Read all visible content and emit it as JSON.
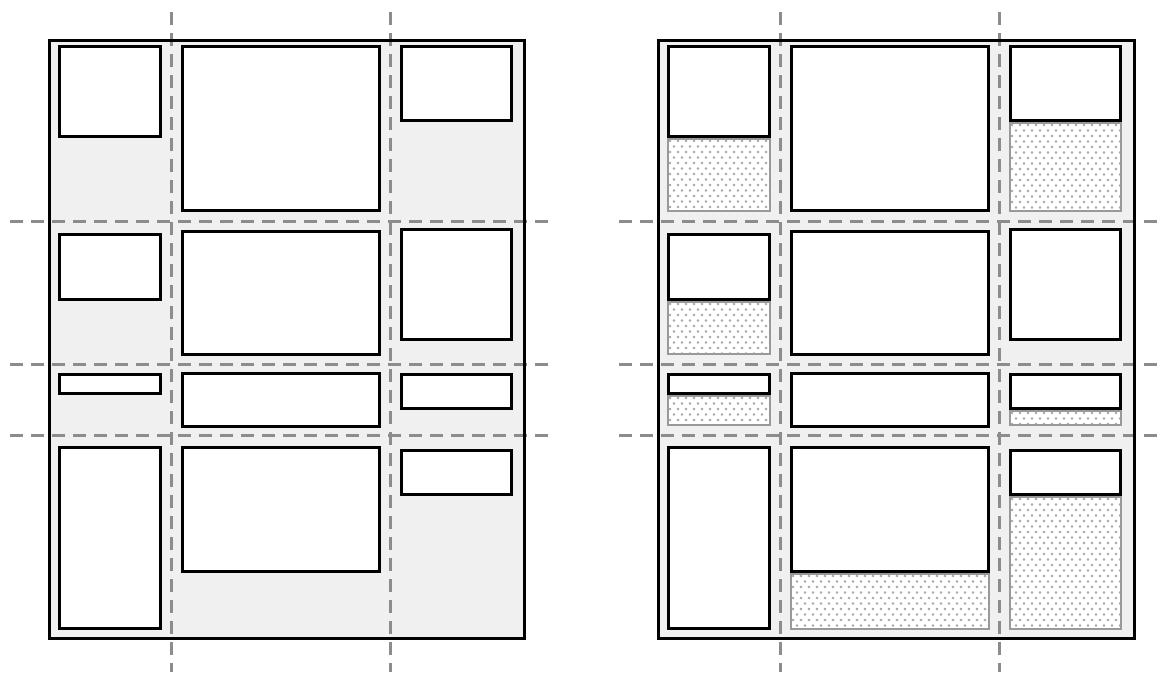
{
  "canvas": {
    "width": 1171,
    "height": 679,
    "background": "#ffffff"
  },
  "colors": {
    "container_fill": "#f0f0f0",
    "container_border": "#000000",
    "item_fill": "#ffffff",
    "item_border": "#000000",
    "grid_line": "#8c8c8c",
    "leftover_border": "#999999",
    "leftover_dots": "#a8a8a8"
  },
  "figures": [
    {
      "id": "plain-grid",
      "container": {
        "x": 48,
        "y": 39,
        "w": 478,
        "h": 601
      },
      "column_lines_x": [
        171,
        390
      ],
      "row_lines_y": [
        221,
        364,
        435
      ],
      "h_line_extent": {
        "x1": 10,
        "x2": 548
      },
      "v_line_extent": {
        "y1": 12,
        "y2": 672
      },
      "items": [
        {
          "row": 1,
          "col": 1,
          "x": 10,
          "y": 6,
          "w": 104,
          "h": 93,
          "leftover_h": 0
        },
        {
          "row": 1,
          "col": 2,
          "x": 133,
          "y": 6,
          "w": 200,
          "h": 167,
          "leftover_h": 0
        },
        {
          "row": 1,
          "col": 3,
          "x": 352,
          "y": 6,
          "w": 113,
          "h": 77,
          "leftover_h": 0
        },
        {
          "row": 2,
          "col": 1,
          "x": 10,
          "y": 194,
          "w": 104,
          "h": 68,
          "leftover_h": 0
        },
        {
          "row": 2,
          "col": 2,
          "x": 133,
          "y": 191,
          "w": 200,
          "h": 126,
          "leftover_h": 0
        },
        {
          "row": 2,
          "col": 3,
          "x": 352,
          "y": 189,
          "w": 113,
          "h": 113,
          "leftover_h": 0
        },
        {
          "row": 3,
          "col": 1,
          "x": 10,
          "y": 334,
          "w": 104,
          "h": 22,
          "leftover_h": 0
        },
        {
          "row": 3,
          "col": 2,
          "x": 133,
          "y": 333,
          "w": 200,
          "h": 56,
          "leftover_h": 0
        },
        {
          "row": 3,
          "col": 3,
          "x": 352,
          "y": 334,
          "w": 113,
          "h": 37,
          "leftover_h": 0
        },
        {
          "row": 4,
          "col": 1,
          "x": 10,
          "y": 407,
          "w": 104,
          "h": 184,
          "leftover_h": 0
        },
        {
          "row": 4,
          "col": 2,
          "x": 133,
          "y": 407,
          "w": 200,
          "h": 127,
          "leftover_h": 0
        },
        {
          "row": 4,
          "col": 3,
          "x": 352,
          "y": 410,
          "w": 113,
          "h": 47,
          "leftover_h": 0
        }
      ]
    },
    {
      "id": "dotted-leftover-grid",
      "container": {
        "x": 657,
        "y": 39,
        "w": 479,
        "h": 601
      },
      "column_lines_x": [
        780,
        999
      ],
      "row_lines_y": [
        221,
        364,
        435
      ],
      "h_line_extent": {
        "x1": 619,
        "x2": 1163
      },
      "v_line_extent": {
        "y1": 12,
        "y2": 672
      },
      "items": [
        {
          "row": 1,
          "col": 1,
          "x": 10,
          "y": 6,
          "w": 104,
          "h": 93,
          "leftover_h": 74
        },
        {
          "row": 1,
          "col": 2,
          "x": 133,
          "y": 6,
          "w": 200,
          "h": 167,
          "leftover_h": 0
        },
        {
          "row": 1,
          "col": 3,
          "x": 352,
          "y": 6,
          "w": 113,
          "h": 77,
          "leftover_h": 90
        },
        {
          "row": 2,
          "col": 1,
          "x": 10,
          "y": 194,
          "w": 104,
          "h": 68,
          "leftover_h": 54
        },
        {
          "row": 2,
          "col": 2,
          "x": 133,
          "y": 191,
          "w": 200,
          "h": 126,
          "leftover_h": 0
        },
        {
          "row": 2,
          "col": 3,
          "x": 352,
          "y": 189,
          "w": 113,
          "h": 113,
          "leftover_h": 0
        },
        {
          "row": 3,
          "col": 1,
          "x": 10,
          "y": 334,
          "w": 104,
          "h": 22,
          "leftover_h": 31
        },
        {
          "row": 3,
          "col": 2,
          "x": 133,
          "y": 333,
          "w": 200,
          "h": 56,
          "leftover_h": 0
        },
        {
          "row": 3,
          "col": 3,
          "x": 352,
          "y": 334,
          "w": 113,
          "h": 37,
          "leftover_h": 16
        },
        {
          "row": 4,
          "col": 1,
          "x": 10,
          "y": 407,
          "w": 104,
          "h": 184,
          "leftover_h": 0
        },
        {
          "row": 4,
          "col": 2,
          "x": 133,
          "y": 407,
          "w": 200,
          "h": 127,
          "leftover_h": 57
        },
        {
          "row": 4,
          "col": 3,
          "x": 352,
          "y": 410,
          "w": 113,
          "h": 47,
          "leftover_h": 134
        }
      ]
    }
  ]
}
